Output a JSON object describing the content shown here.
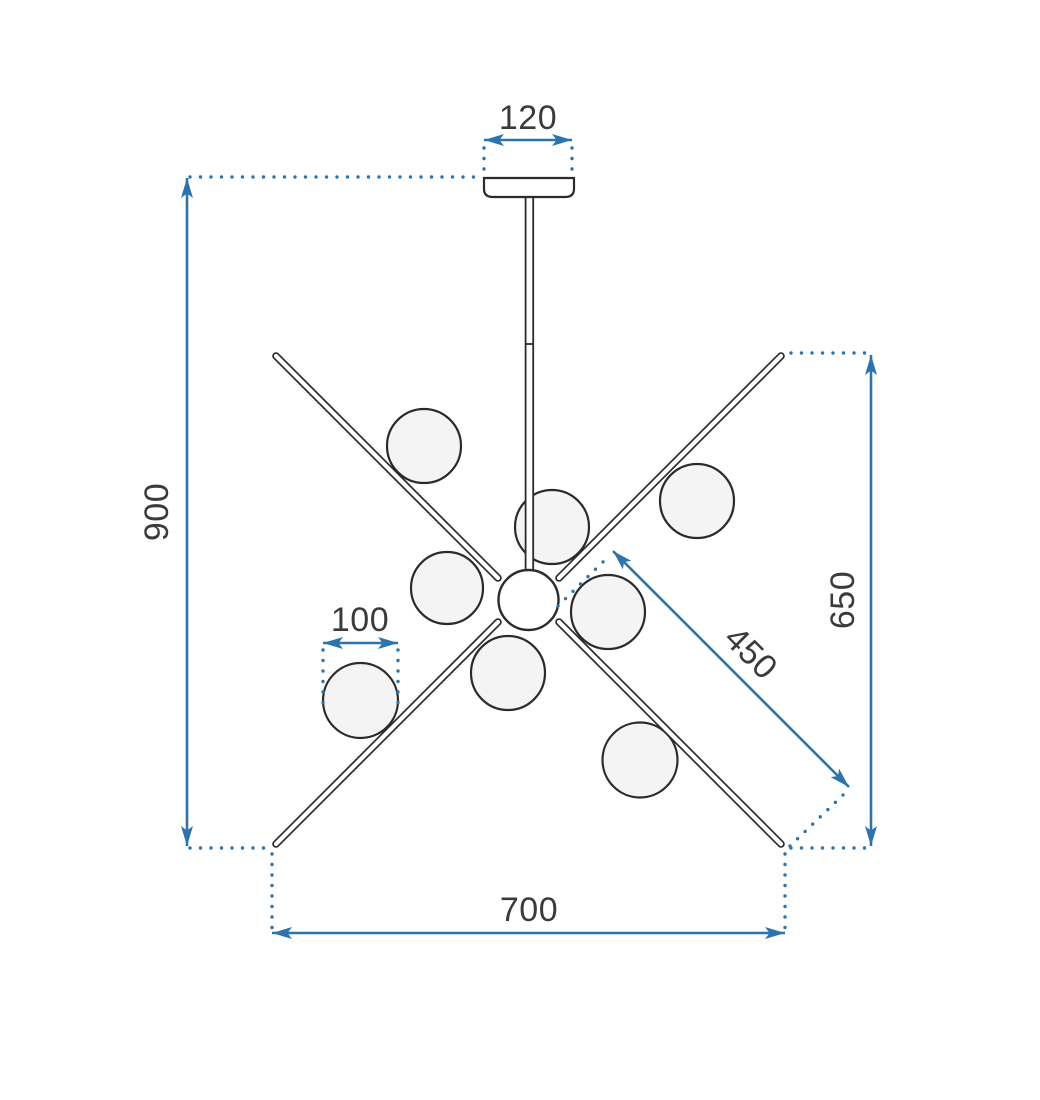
{
  "drawing": {
    "type": "technical-dimension-diagram",
    "subject": "sputnik chandelier with 8 glass balls, front view",
    "labels": {
      "plate_width": "120",
      "overall_height": "900",
      "overall_width": "700",
      "arm_span_height": "650",
      "arm_length": "450",
      "ball_diameter": "100"
    },
    "parts": {
      "glass_balls": 8,
      "arms": 4
    },
    "colors": {
      "dimension_accent": "#2b74ad",
      "line_ink": "#2b2b2b",
      "label_text": "#3b3b3b",
      "ball_fill": "#f4f4f4",
      "background": "#ffffff"
    }
  }
}
